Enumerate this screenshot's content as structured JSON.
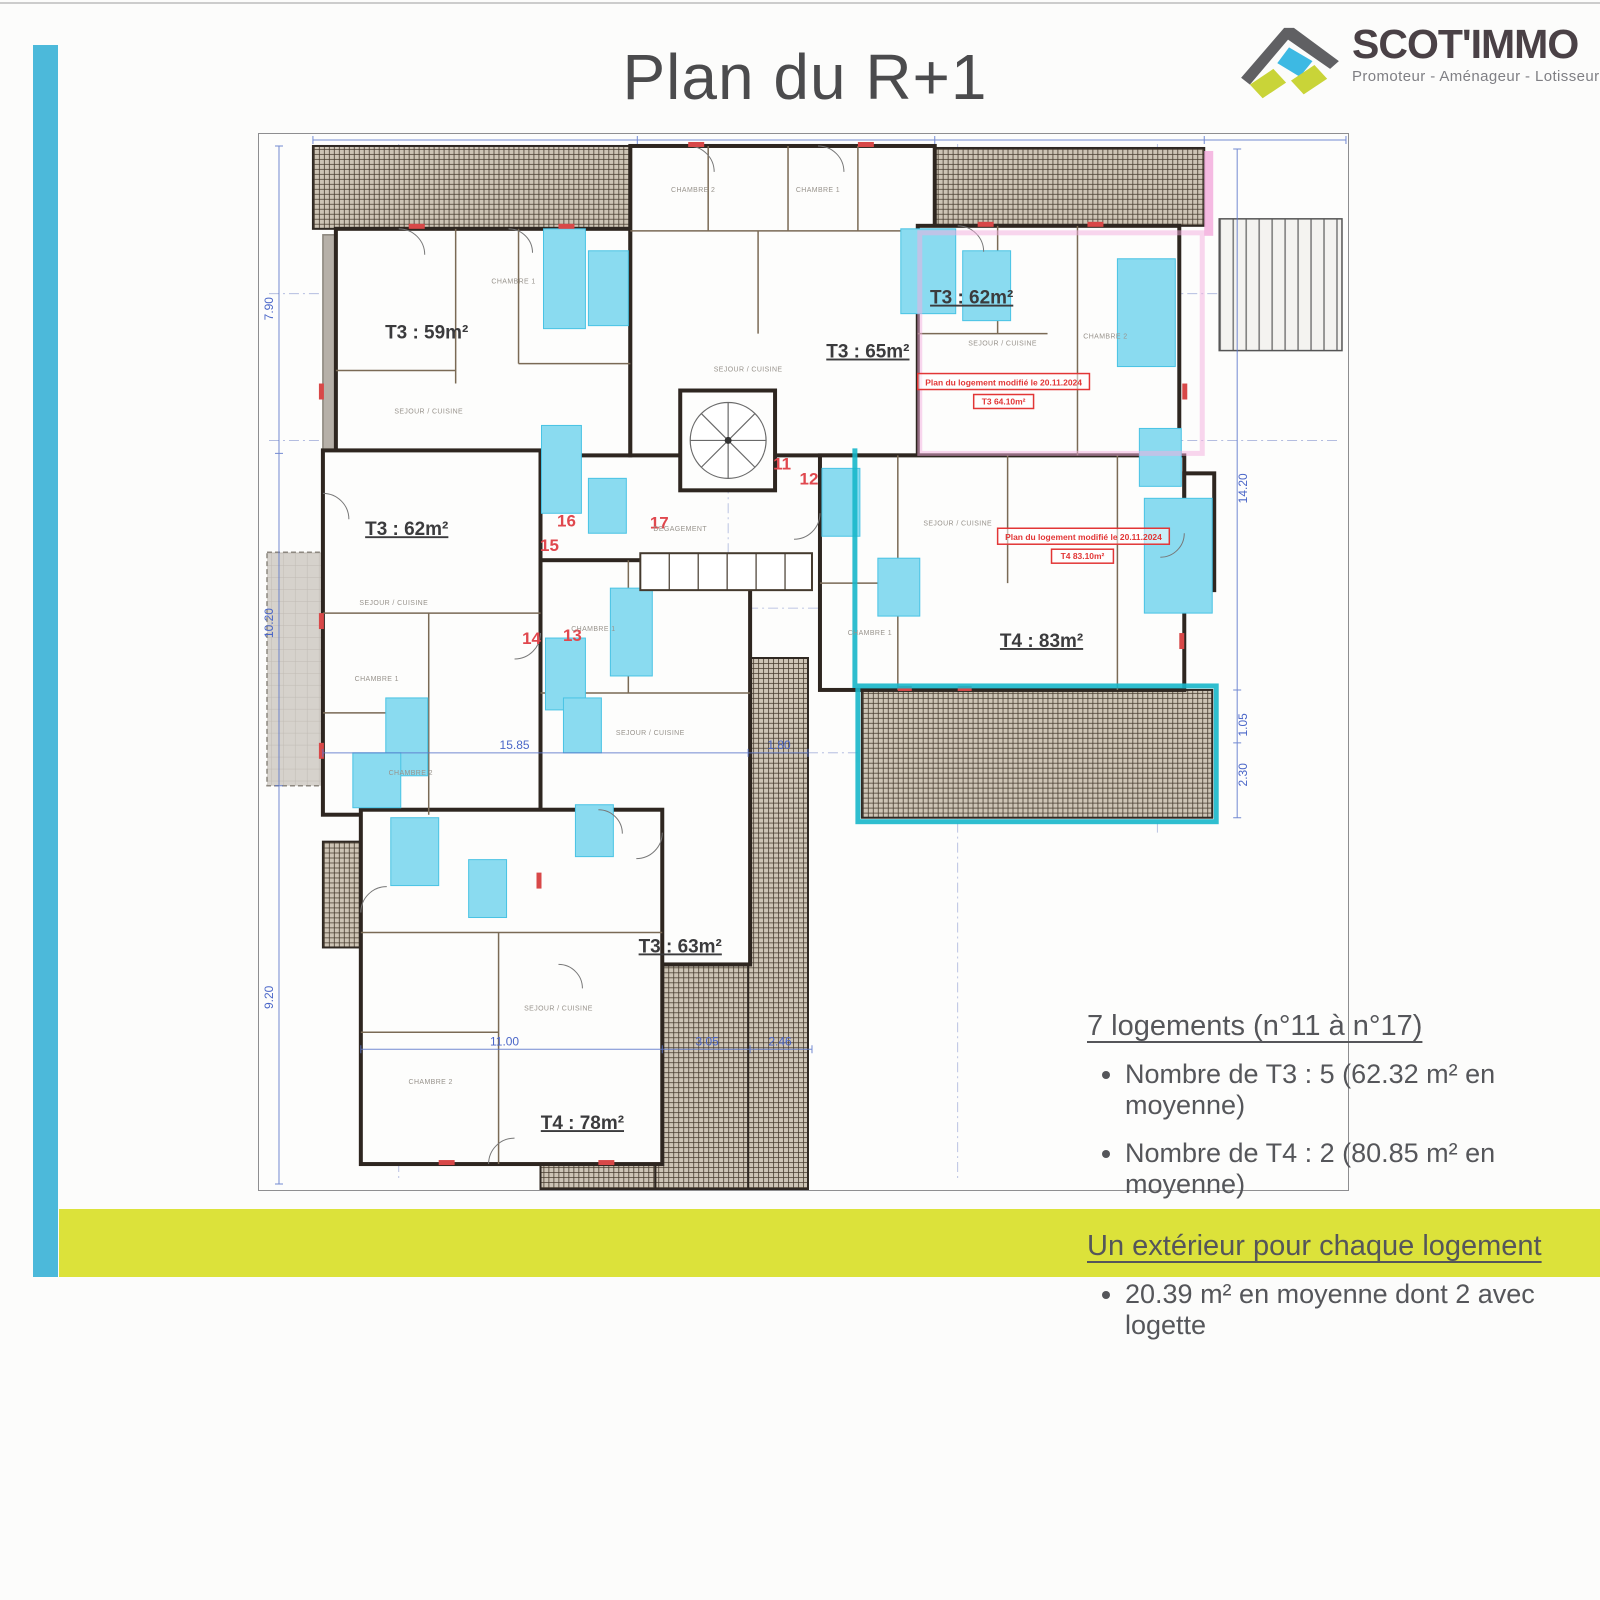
{
  "page": {
    "title": "Plan du R+1"
  },
  "logo": {
    "name": "SCOT'IMMO",
    "tagline": "Promoteur - Aménageur - Lotisseur"
  },
  "summary": {
    "heading1": "7 logements (n°11 à n°17)",
    "bullets1": [
      "Nombre de T3 : 5 (62.32 m² en moyenne)",
      "Nombre de T4 : 2 (80.85 m² en moyenne)"
    ],
    "heading2": "Un extérieur pour chaque logement",
    "bullets2": [
      "20.39 m² en moyenne dont 2 avec logette"
    ]
  },
  "plan": {
    "apartment_labels": [
      {
        "text": "T3 : 59m²",
        "x": 168,
        "y": 205,
        "underline": false
      },
      {
        "text": "T3 : 65m²",
        "x": 610,
        "y": 224
      },
      {
        "text": "T3 : 62m²",
        "x": 714,
        "y": 170
      },
      {
        "text": "T3 : 62m²",
        "x": 148,
        "y": 402
      },
      {
        "text": "T4 : 83m²",
        "x": 784,
        "y": 514
      },
      {
        "text": "T3 : 63m²",
        "x": 422,
        "y": 820
      },
      {
        "text": "T4 : 78m²",
        "x": 324,
        "y": 997
      }
    ],
    "unit_numbers": [
      {
        "text": "11",
        "x": 524,
        "y": 336
      },
      {
        "text": "12",
        "x": 551,
        "y": 351
      },
      {
        "text": "16",
        "x": 308,
        "y": 393
      },
      {
        "text": "15",
        "x": 291,
        "y": 418
      },
      {
        "text": "17",
        "x": 401,
        "y": 395
      },
      {
        "text": "14",
        "x": 273,
        "y": 511
      },
      {
        "text": "13",
        "x": 314,
        "y": 508
      }
    ],
    "annotations": [
      {
        "text": "Plan du logement modifié le 20.11.2024",
        "x": 660,
        "y": 240,
        "w": 172,
        "h": 16
      },
      {
        "text": "T3 64.10m²",
        "x": 716,
        "y": 261,
        "w": 60,
        "h": 14
      },
      {
        "text": "Plan du logement modifié le 20.11.2024",
        "x": 740,
        "y": 395,
        "w": 172,
        "h": 16
      },
      {
        "text": "T4 83.10m²",
        "x": 794,
        "y": 416,
        "w": 62,
        "h": 14
      }
    ],
    "dimensions": [
      {
        "text": "7.90",
        "x": 14,
        "y": 175,
        "r": -90
      },
      {
        "text": "10.20",
        "x": 14,
        "y": 490,
        "r": -90
      },
      {
        "text": "9.20",
        "x": 14,
        "y": 865,
        "r": -90
      },
      {
        "text": "14.20",
        "x": 990,
        "y": 355,
        "r": -90
      },
      {
        "text": "1.05",
        "x": 990,
        "y": 592,
        "r": -90
      },
      {
        "text": "2.30",
        "x": 990,
        "y": 642,
        "r": -90
      },
      {
        "text": "15.85",
        "x": 256,
        "y": 616
      },
      {
        "text": "1.80",
        "x": 521,
        "y": 616
      },
      {
        "text": "11.00",
        "x": 246,
        "y": 913
      },
      {
        "text": "3.05",
        "x": 449,
        "y": 913
      },
      {
        "text": "2.46",
        "x": 522,
        "y": 913
      }
    ],
    "room_labels": [
      {
        "text": "SEJOUR / CUISINE",
        "x": 170,
        "y": 280
      },
      {
        "text": "CHAMBRE 1",
        "x": 255,
        "y": 150
      },
      {
        "text": "CHAMBRE 2",
        "x": 435,
        "y": 58
      },
      {
        "text": "CHAMBRE 1",
        "x": 560,
        "y": 58
      },
      {
        "text": "SEJOUR / CUISINE",
        "x": 490,
        "y": 238
      },
      {
        "text": "SEJOUR / CUISINE",
        "x": 745,
        "y": 212
      },
      {
        "text": "CHAMBRE 2",
        "x": 848,
        "y": 205
      },
      {
        "text": "SEJOUR / CUISINE",
        "x": 135,
        "y": 472
      },
      {
        "text": "CHAMBRE 1",
        "x": 118,
        "y": 548
      },
      {
        "text": "CHAMBRE 2",
        "x": 152,
        "y": 642
      },
      {
        "text": "SEJOUR / CUISINE",
        "x": 392,
        "y": 602
      },
      {
        "text": "CHAMBRE 1",
        "x": 335,
        "y": 498
      },
      {
        "text": "SEJOUR / CUISINE",
        "x": 300,
        "y": 878
      },
      {
        "text": "CHAMBRE 2",
        "x": 172,
        "y": 952
      },
      {
        "text": "SEJOUR / CUISINE",
        "x": 700,
        "y": 392
      },
      {
        "text": "CHAMBRE 1",
        "x": 612,
        "y": 502
      },
      {
        "text": "DEGAGEMENT",
        "x": 422,
        "y": 398
      }
    ]
  },
  "colors": {
    "side_bar": "#4cb9da",
    "bottom_bar": "#dce23a",
    "highlight_room": "#8adbf0",
    "modification_red": "#e23636",
    "marker_teal": "#18b7ca",
    "marker_pink": "#f3aedd",
    "dimension_blue": "#5b76ca"
  }
}
